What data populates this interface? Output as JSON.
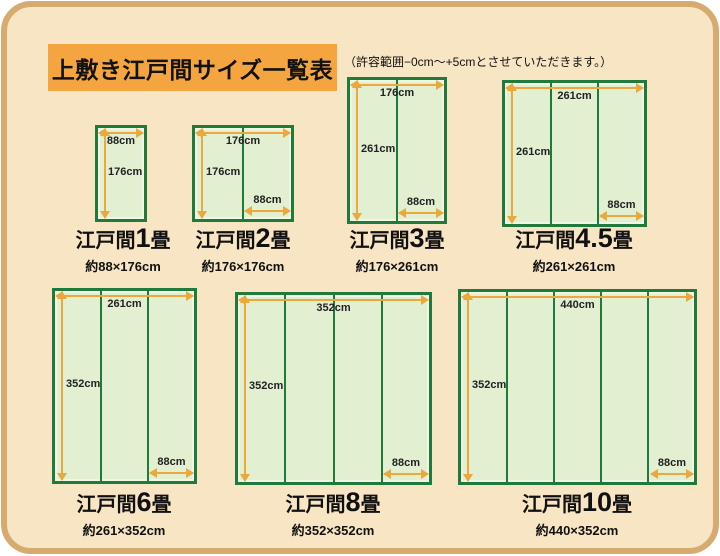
{
  "page": {
    "title": "上敷き江戸間サイズ一覧表",
    "note": "（許容範囲−0cm〜+5cmとさせていただきます。）"
  },
  "colors": {
    "card_background": "#f8e5c4",
    "card_border": "#d6ab70",
    "title_badge": "#f4a53f",
    "mat_fill": "#e2efd1",
    "mat_border": "#1f7a3b",
    "arrow": "#eaa83d"
  },
  "sizes": [
    {
      "name_prefix": "江戸間",
      "name_num": "1",
      "name_suffix": "畳",
      "dims": "約88×176cm",
      "width_label": "88cm",
      "height_label": "176cm",
      "mat_width_label": "",
      "mats": 1
    },
    {
      "name_prefix": "江戸間",
      "name_num": "2",
      "name_suffix": "畳",
      "dims": "約176×176cm",
      "width_label": "176cm",
      "height_label": "176cm",
      "mat_width_label": "88cm",
      "mats": 2
    },
    {
      "name_prefix": "江戸間",
      "name_num": "3",
      "name_suffix": "畳",
      "dims": "約176×261cm",
      "width_label": "176cm",
      "height_label": "261cm",
      "mat_width_label": "88cm",
      "mats": 2
    },
    {
      "name_prefix": "江戸間",
      "name_num": "4.5",
      "name_suffix": "畳",
      "dims": "約261×261cm",
      "width_label": "261cm",
      "height_label": "261cm",
      "mat_width_label": "88cm",
      "mats": 3
    },
    {
      "name_prefix": "江戸間",
      "name_num": "6",
      "name_suffix": "畳",
      "dims": "約261×352cm",
      "width_label": "261cm",
      "height_label": "352cm",
      "mat_width_label": "88cm",
      "mats": 3
    },
    {
      "name_prefix": "江戸間",
      "name_num": "8",
      "name_suffix": "畳",
      "dims": "約352×352cm",
      "width_label": "352cm",
      "height_label": "352cm",
      "mat_width_label": "88cm",
      "mats": 4
    },
    {
      "name_prefix": "江戸間",
      "name_num": "10",
      "name_suffix": "畳",
      "dims": "約440×352cm",
      "width_label": "440cm",
      "height_label": "352cm",
      "mat_width_label": "88cm",
      "mats": 5
    }
  ]
}
